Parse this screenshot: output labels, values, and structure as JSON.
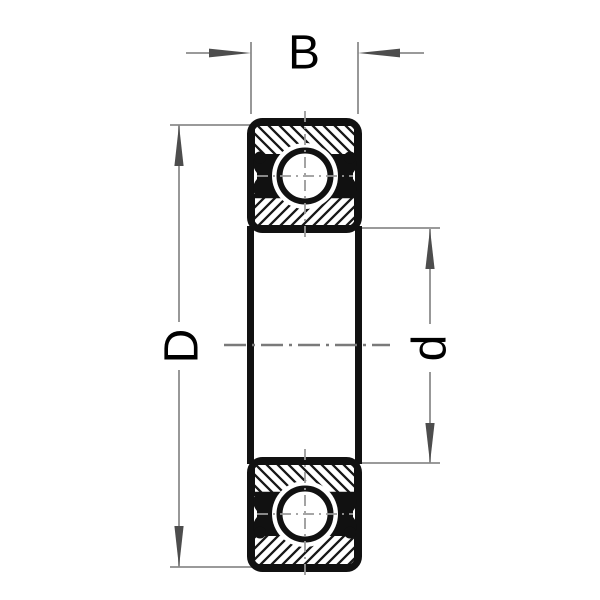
{
  "diagram": {
    "type": "ball-bearing-cross-section-drawing",
    "labels": {
      "width": "B",
      "outer_diameter": "D",
      "bore_diameter": "d"
    },
    "colors": {
      "background": "#ffffff",
      "outline": "#111111",
      "hatch": "#161616",
      "dimension_line": "#8c8c8c",
      "arrow": "#4d4d4d",
      "axis_centerline": "#7a7a7a",
      "ball_centerline": "#999999",
      "text": "#000000"
    }
  }
}
